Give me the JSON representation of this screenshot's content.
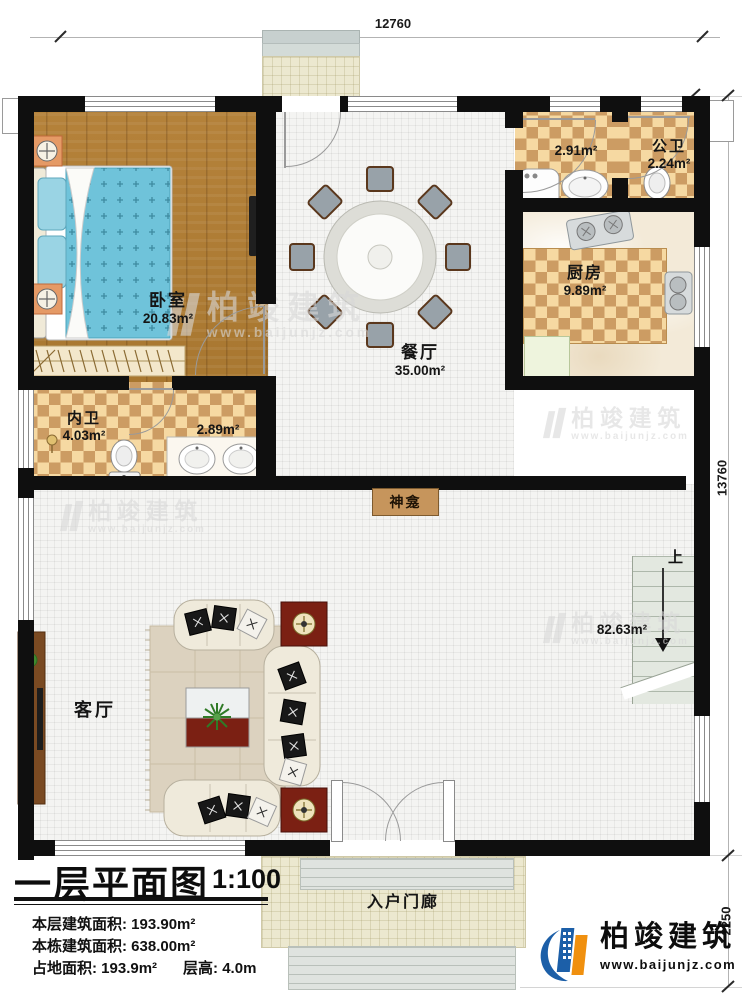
{
  "dimensions": {
    "top": "12760",
    "right": "13760",
    "bottom_right": "2250"
  },
  "rooms": {
    "bedroom": {
      "name": "卧室",
      "area": "20.83m²"
    },
    "master_bath": {
      "name": "内卫",
      "area": "4.03m²"
    },
    "vanity": {
      "area": "2.89m²"
    },
    "dining": {
      "name": "餐厅",
      "area": "35.00m²"
    },
    "laundry": {
      "area": "2.91m²"
    },
    "public_bath": {
      "name": "公卫",
      "area": "2.24m²"
    },
    "kitchen": {
      "name": "厨房",
      "area": "9.89m²"
    },
    "shrine": {
      "name": "神龛"
    },
    "living": {
      "name": "客厅",
      "area": "82.63m²"
    },
    "stairs": {
      "up_label": "上"
    },
    "entry_porch": {
      "name": "入户门廊"
    }
  },
  "title_block": {
    "title": "一层平面图",
    "scale": "1:100",
    "stats": [
      {
        "label": "本层建筑面积: ",
        "value": "193.90m²"
      },
      {
        "label": "本栋建筑面积: ",
        "value": "638.00m²"
      },
      {
        "label": "占地面积: ",
        "value": "193.9m²"
      },
      {
        "label": "层高: ",
        "value": "4.0m"
      }
    ]
  },
  "brand": {
    "name": "柏竣建筑",
    "url": "www.baijunjz.com"
  },
  "watermark": {
    "name": "柏竣建筑",
    "url": "www.baijunjz.com"
  },
  "colors": {
    "wall": "#0f0f0f",
    "checker_light": "#f6d9a2",
    "checker_dark": "#cc9c63",
    "wood_floor": "#b0813a",
    "bed_blue": "#6fc3da",
    "accent_red": "#7b2013",
    "brand_blue": "#1c5fa8",
    "brand_orange": "#f0900f"
  }
}
